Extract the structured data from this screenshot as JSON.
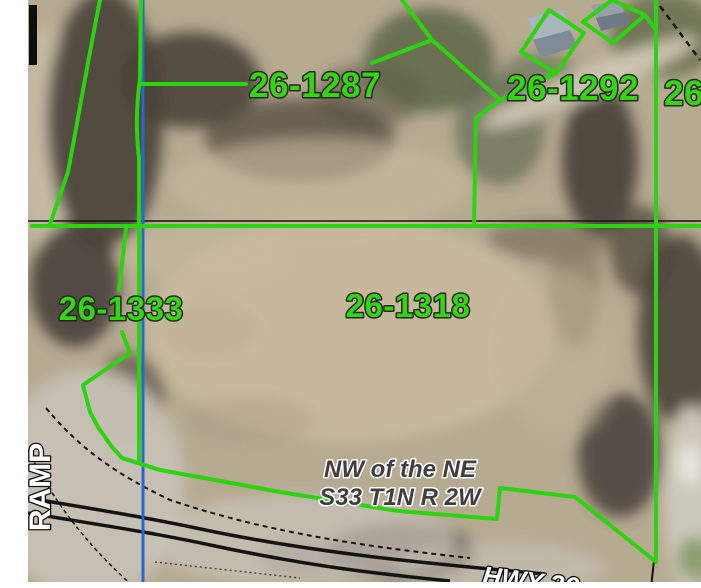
{
  "map": {
    "type": "parcel-aerial-map",
    "parcel_labels": {
      "p26_1287": "26-1287",
      "p26_1292": "26-1292",
      "p26_right_partial": "26-",
      "p26_1333": "26-1333",
      "p26_1318": "26-1318"
    },
    "annotations": {
      "section_text_line1": "NW of the NE",
      "section_text_line2": "S33 T1N R 2W",
      "ramp_label": "RAMP",
      "highway_label": "HWY 36"
    },
    "colors": {
      "parcel_line_green": "#2bd40e",
      "parcel_label_green": "#35d414",
      "section_line_blue": "#2b66cf",
      "road_line_black": "#141414",
      "section_text_gray": "#3f3f3f",
      "road_label_white": "#ffffff",
      "aerial_field_tan": "#b6aa91",
      "aerial_trees_dark": "#4e473d",
      "aerial_pavement_gray": "#c6c1b5"
    }
  }
}
